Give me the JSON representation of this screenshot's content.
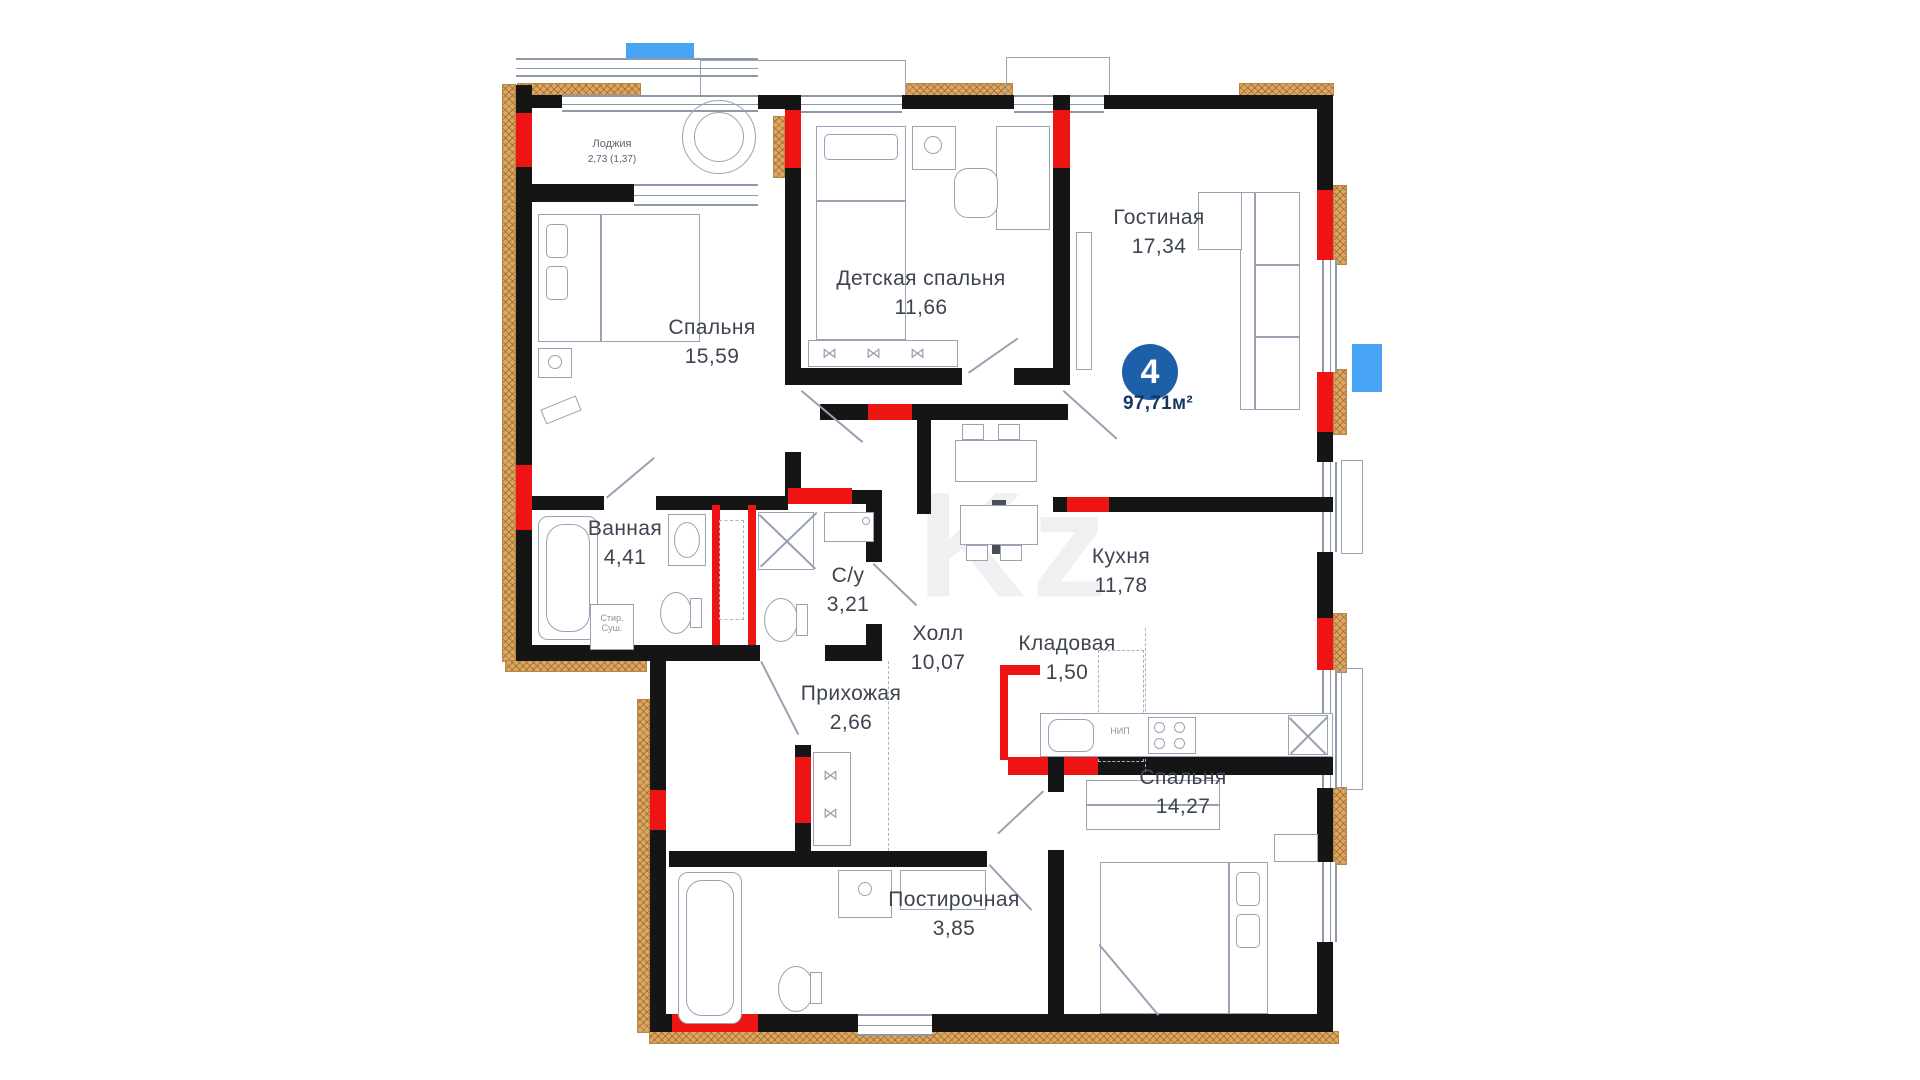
{
  "plan": {
    "watermark": "Kz",
    "badge": {
      "number": "4",
      "area": "97,71м²"
    },
    "rooms": [
      {
        "name": "Лоджия",
        "area": "2,73 (1,37)"
      },
      {
        "name": "Спальня",
        "area": "15,59"
      },
      {
        "name": "Детская спальня",
        "area": "11,66"
      },
      {
        "name": "Гостиная",
        "area": "17,34"
      },
      {
        "name": "Ванная",
        "area": "4,41"
      },
      {
        "name": "С/у",
        "area": "3,21"
      },
      {
        "name": "Холл",
        "area": "10,07"
      },
      {
        "name": "Прихожая",
        "area": "2,66"
      },
      {
        "name": "Кухня",
        "area": "11,78"
      },
      {
        "name": "Кладовая",
        "area": "1,50"
      },
      {
        "name": "Постирочная",
        "area": "3,85"
      },
      {
        "name": "Спальня",
        "area": "14,27"
      }
    ],
    "fixtures": {
      "washer": "Стир.",
      "dryer": "Суш.",
      "cooktop": "НИП"
    },
    "colors": {
      "wall": "#151515",
      "load_bearing": "#ee1414",
      "insulation": "#dca763",
      "marker_blue": "#47a3f3",
      "badge_blue": "#1d5fa8",
      "label": "#3e4450"
    }
  }
}
